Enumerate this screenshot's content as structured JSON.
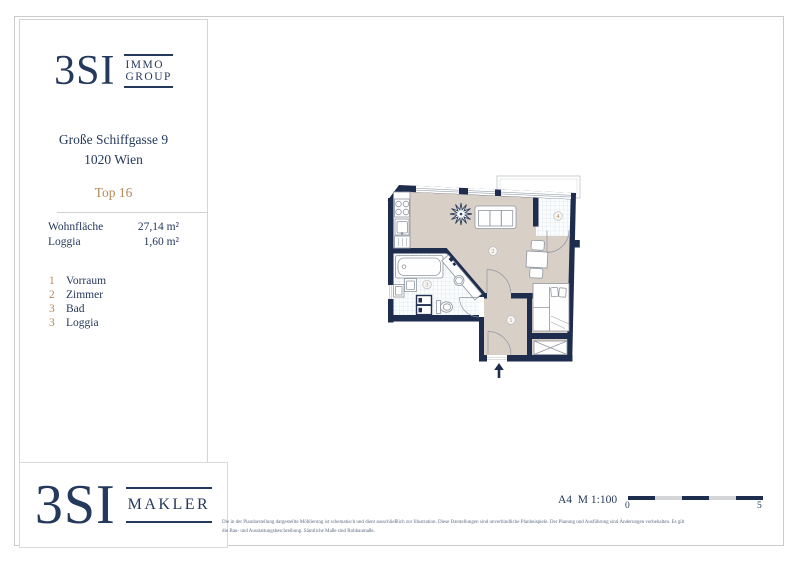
{
  "sidebar": {
    "logo": {
      "brand": "3SI",
      "line1": "IMMO",
      "line2": "GROUP"
    },
    "address_line1": "Große Schiffgasse 9",
    "address_line2": "1020 Wien",
    "unit": "Top 16",
    "areas": [
      {
        "label": "Wohnfläche",
        "value": "27,14 m²"
      },
      {
        "label": "Loggia",
        "value": "1,60 m²"
      }
    ],
    "legend": [
      {
        "no": "1",
        "label": "Vorraum"
      },
      {
        "no": "2",
        "label": "Zimmer"
      },
      {
        "no": "3",
        "label": "Bad"
      },
      {
        "no": "3",
        "label": "Loggia"
      }
    ]
  },
  "makler_logo": {
    "brand": "3SI",
    "word": "MAKLER"
  },
  "plan": {
    "room_numbers": [
      "1",
      "2",
      "3",
      "4"
    ]
  },
  "footer": {
    "format_scale": "A4  M 1:100",
    "scale_start": "0",
    "scale_end": "5",
    "disclaimer_line1": "Die in der Plandarstellung dargestellte Möblierung ist schematisch und dient ausschließlich zur Illustration. Diese Darstellungen sind unverbindliche Planbeispiele. Der Planung und Ausführung sind Änderungen vorbehalten. Es gilt",
    "disclaimer_line2": "die Bau- und Ausstattungsbeschreibung. Sämtliche Maße sind Rohbaumaße."
  },
  "colors": {
    "navy": "#25395c",
    "wall": "#1e2c4e",
    "gold": "#b5895a",
    "floor_beige": "#d8cfc6",
    "tile_line": "#cfdae0",
    "frame_gray": "#c9ccce"
  }
}
